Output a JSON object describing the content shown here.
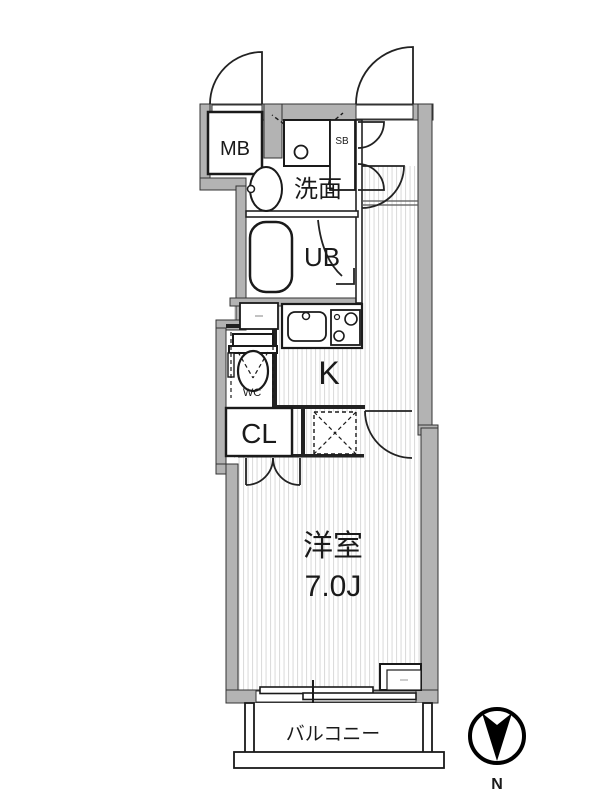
{
  "floor_plan": {
    "type": "japanese-apartment-floor-plan",
    "rooms": {
      "meter_box": {
        "label": "MB"
      },
      "shoe_box": {
        "label": "SB"
      },
      "washroom": {
        "label": "洗面"
      },
      "unit_bath": {
        "label": "UB"
      },
      "kitchen": {
        "label": "K"
      },
      "toilet": {
        "label": "WC"
      },
      "closet": {
        "label": "CL"
      },
      "western_room": {
        "label": "洋室",
        "size": "7.0J"
      },
      "balcony": {
        "label": "バルコニー"
      }
    },
    "compass": {
      "label": "N",
      "orientation": "north-points-down"
    },
    "colors": {
      "wall": "#b3b3b3",
      "line": "#2b2b2b",
      "stripe": "#dcdcdc",
      "background": "#ffffff"
    }
  }
}
